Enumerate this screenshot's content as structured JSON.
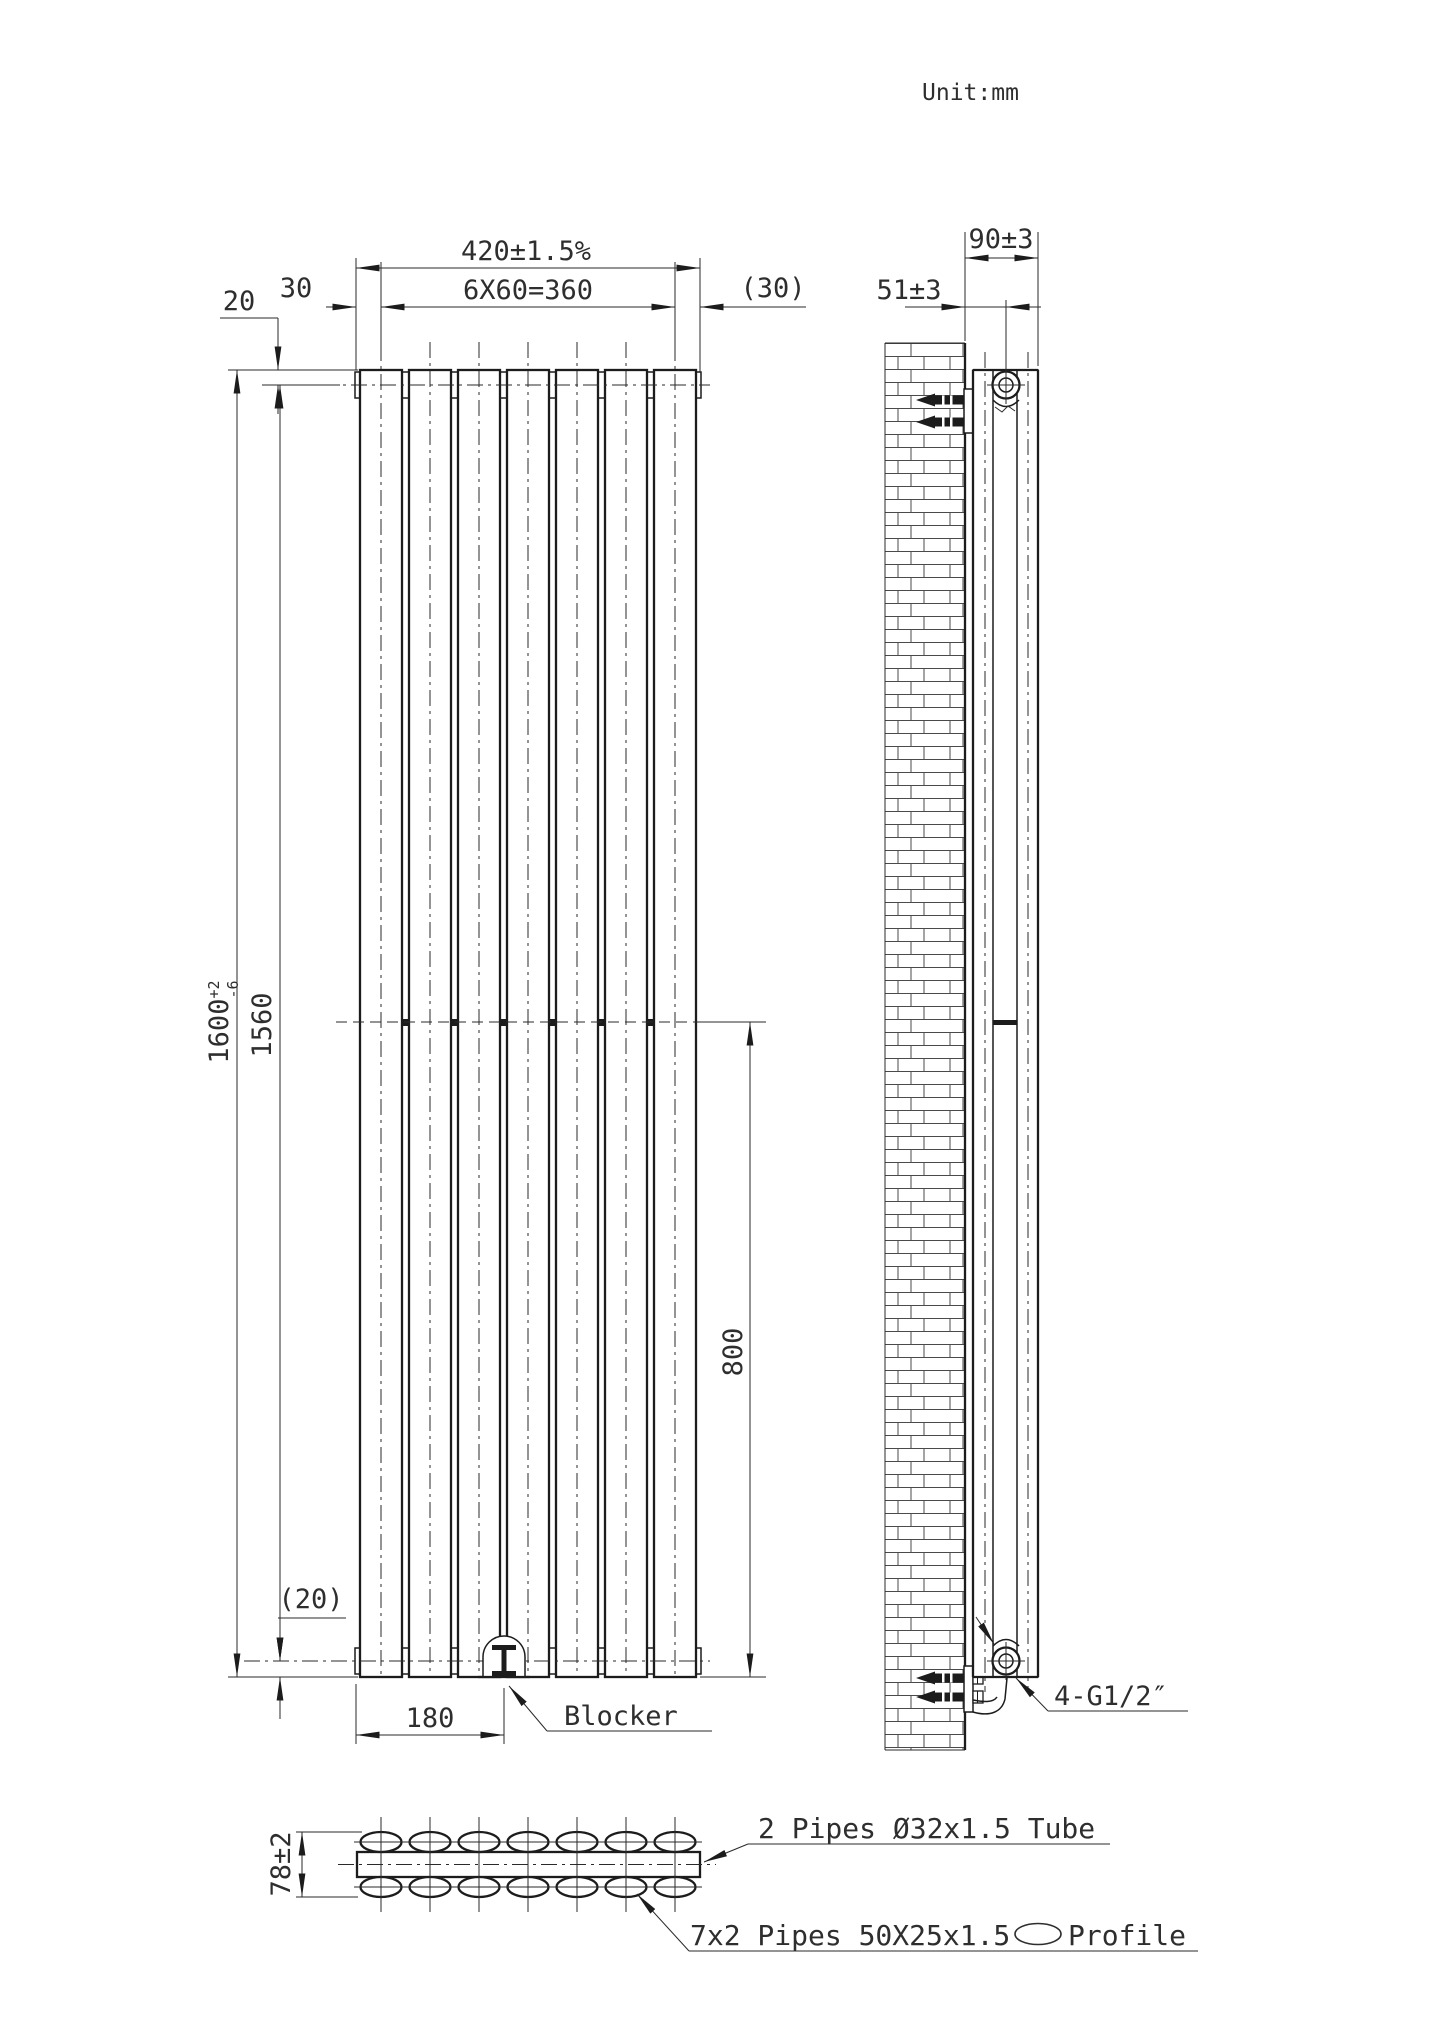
{
  "title": {
    "unit_label": "Unit:mm"
  },
  "front_view": {
    "dim_width_total": "420±1.5%",
    "dim_panel_pitch": "6X60=360",
    "dim_left_margin": "30",
    "dim_right_margin": "(30)",
    "dim_top_pipe_offset": "20",
    "dim_height": "1600",
    "dim_height_tol_upper": "+2",
    "dim_height_tol_lower": "-6",
    "dim_pipe_to_pipe": "1560",
    "dim_bottom_pipe_offset": "(20)",
    "dim_mid_to_bottom": "800",
    "dim_blocker_offset": "180",
    "label_blocker": "Blocker"
  },
  "side_view": {
    "dim_depth": "90±3",
    "dim_wall_to_axis": "51±3",
    "label_connections": "4-G1/2″"
  },
  "section_view": {
    "dim_thickness": "78±2",
    "label_header_tube": "2 Pipes Ø32x1.5 Tube",
    "label_oval_pipes_prefix": "7x2 Pipes 50X25x1.5",
    "label_oval_pipes_suffix": "Profile"
  }
}
